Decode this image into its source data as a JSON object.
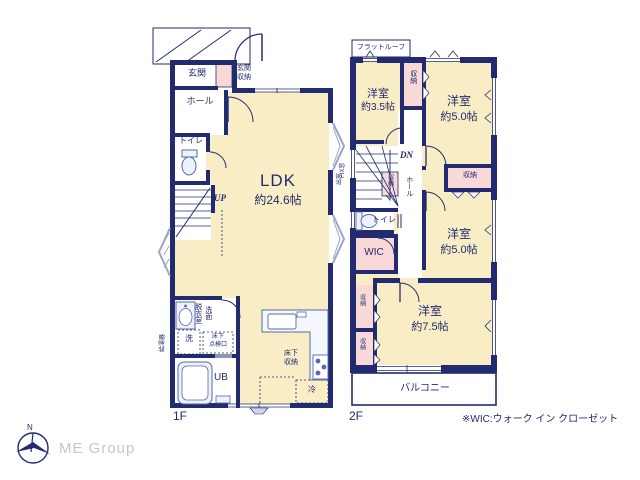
{
  "colors": {
    "wall_navy": "#222b6f",
    "room_cream": "#f9edc6",
    "closet_pink": "#f8d9d8",
    "fixture_blue": "#5668a8",
    "fixture_fill": "#eef2fa",
    "bay_lavender": "#9aa6cc",
    "logo_gray": "#c6c6c6"
  },
  "floor1": {
    "label": "1F",
    "genkan": "玄関",
    "genkan_storage_l1": "玄関",
    "genkan_storage_l2": "収納",
    "hall": "ホール",
    "toilet": "トイレ",
    "up": "UP",
    "ldk_name": "LDK",
    "ldk_size": "約24.6帖",
    "dressing_room": "脱衣室",
    "washstand": "洗面",
    "washer": "洗",
    "underfloor_hatch_l1": "床下",
    "underfloor_hatch_l2": "点検口",
    "unit_bath": "UB",
    "underfloor_storage_l1": "床下",
    "underfloor_storage_l2": "収納",
    "fridge": "冷",
    "annotation_left": "給湯器",
    "annotation_right": "出窓"
  },
  "floor2": {
    "label": "2F",
    "flat_roof": "フラットルーフ",
    "room_name": "洋室",
    "room_nw_size": "約3.5帖",
    "room_ne_size": "約5.0帖",
    "room_e_size": "約5.0帖",
    "room_s_size": "約7.5帖",
    "dn": "DN",
    "hall": "ホール",
    "toilet": "トイレ",
    "wic": "WIC",
    "closet": "収納",
    "balcony": "バルコニー",
    "annotation_left": "FIX窓"
  },
  "footer": {
    "wic_note": "※WIC:ウォーク イン クローゼット",
    "logo_text": "ME Group",
    "compass_north": "N"
  }
}
